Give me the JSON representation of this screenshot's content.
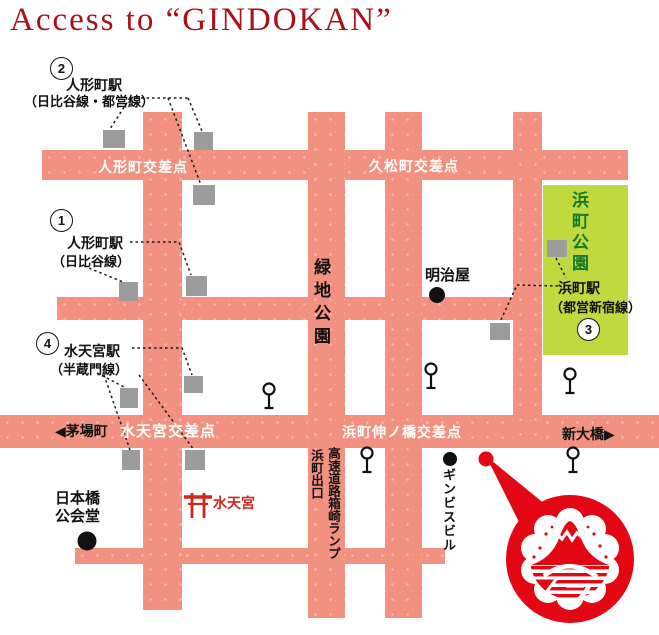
{
  "title": "Access to “GINDOKAN”",
  "stations": {
    "s1": {
      "num": "1",
      "name": "人形町駅",
      "line": "（日比谷線）"
    },
    "s2": {
      "num": "2",
      "name": "人形町駅",
      "line": "（日比谷線・都営線）"
    },
    "s3": {
      "num": "3",
      "name": "浜町駅",
      "line": "（都営新宿線）"
    },
    "s4": {
      "num": "4",
      "name": "水天宮駅",
      "line": "（半蔵門線）"
    }
  },
  "intersections": {
    "ningyocho": "人形町交差点",
    "hisamatsucho": "久松町交差点",
    "suitengu": "水天宮交差点",
    "hamacho_nobashi": "浜町伸ノ橋交差点"
  },
  "directions": {
    "kayabacho": "◀茅場町",
    "shin_ohashi": "新大橋▶"
  },
  "places": {
    "meijiya": "明治屋",
    "hamacho_park": "浜町公園",
    "ryokuchi_park": "緑地公園",
    "nihonbashi_hall_line1": "日本橋",
    "nihonbashi_hall_line2": "公会堂",
    "suitengu_shrine": "水天宮",
    "ginbis_bldg": "ギンビスビル",
    "expressway_ramp": "高速道路箱崎ランプ",
    "hamacho_exit": "浜町出口"
  },
  "colors": {
    "road": "#f29180",
    "park_bg": "#bfd93f",
    "park_text": "#137a26",
    "accent_red": "#e30613",
    "shrine_red": "#d1261b",
    "title_red": "#ab1016",
    "marker_gray": "#9c9c9c"
  }
}
